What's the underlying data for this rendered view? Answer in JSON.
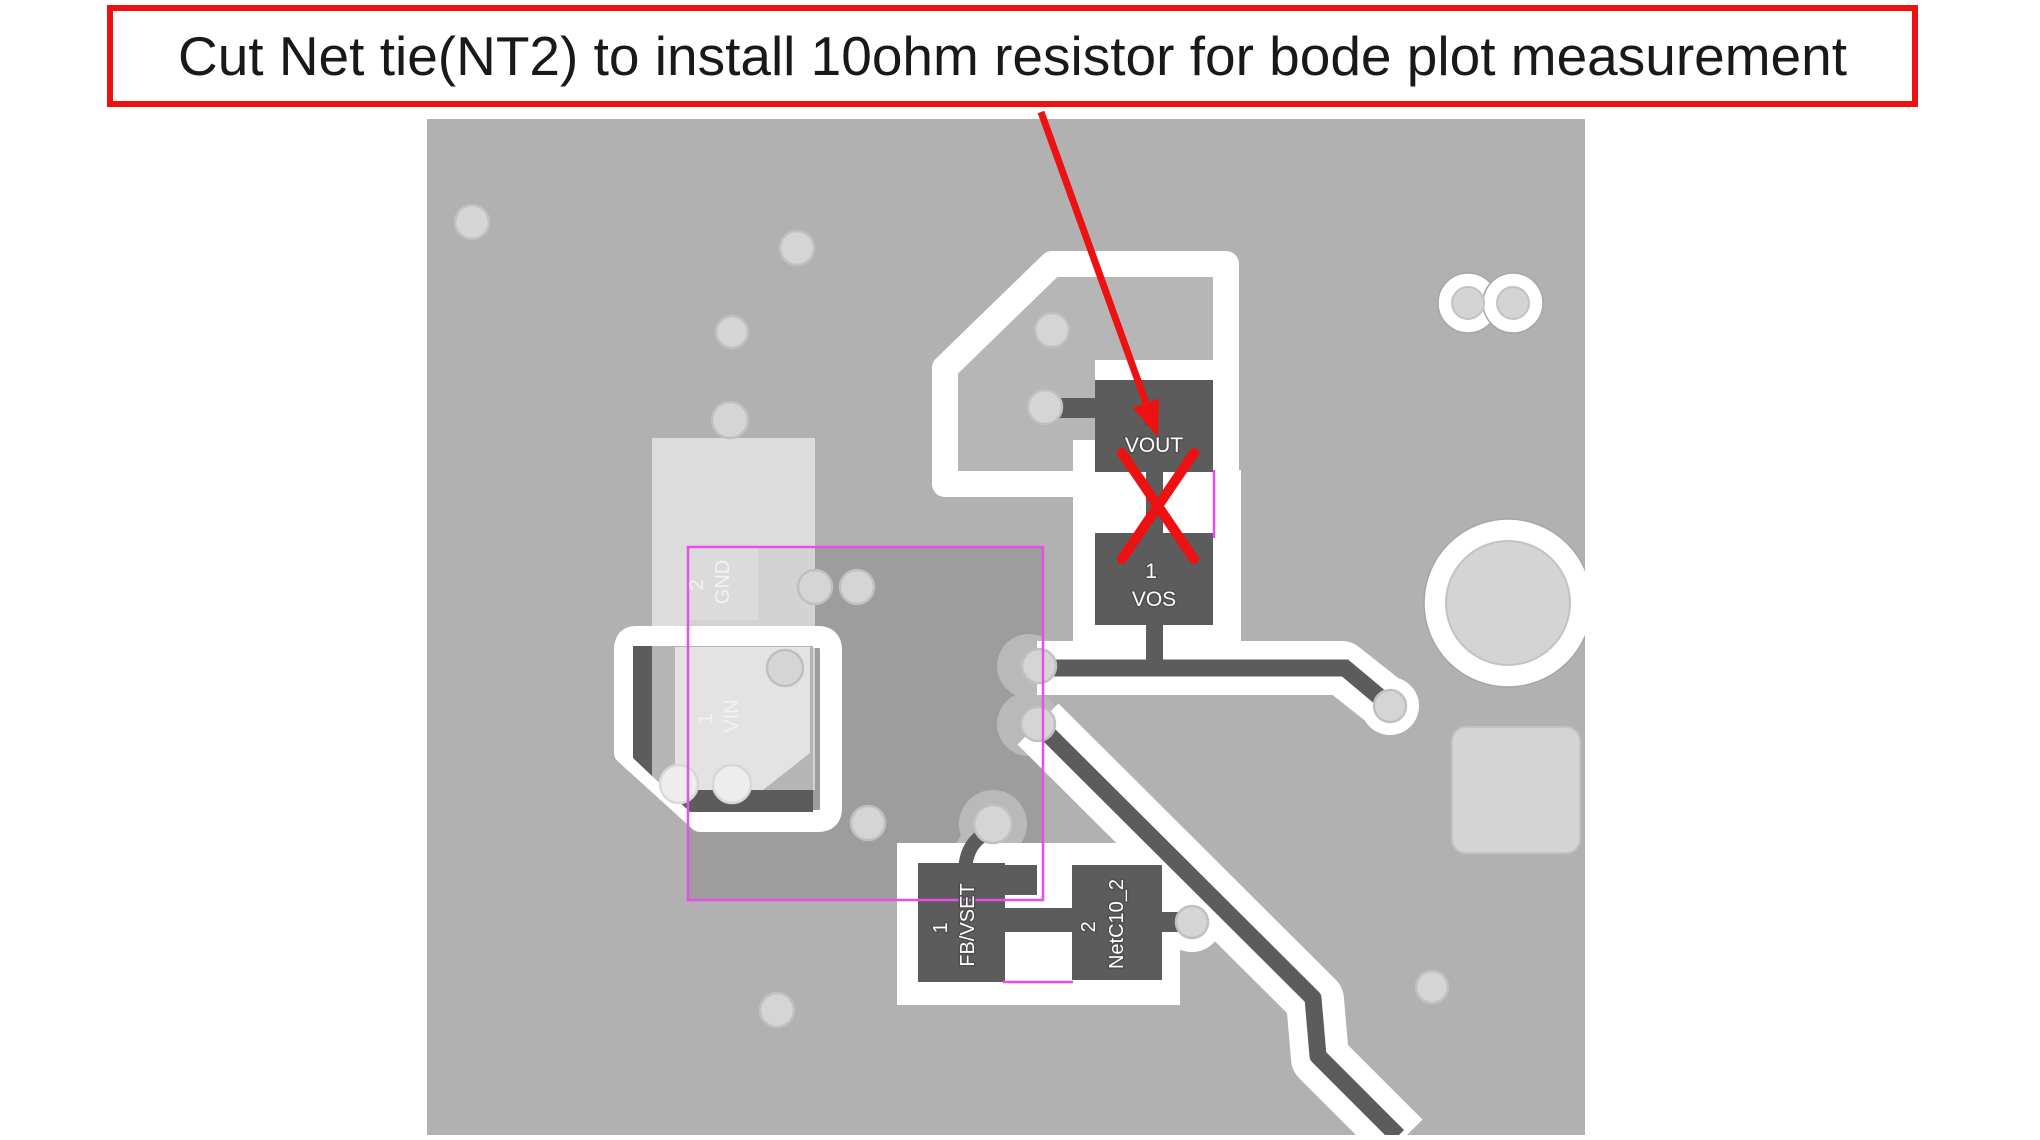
{
  "callout": {
    "text": "Cut Net tie(NT2) to install 10ohm resistor for bode plot measurement"
  },
  "board": {
    "pads": {
      "vout_pin": "2",
      "vout": "VOUT",
      "vos_pin": "1",
      "vos": "VOS",
      "fb_pin": "1",
      "fb": "FB/VSET",
      "netc_pin": "2",
      "netc": "NetC10_2",
      "gnd_pin": "2",
      "gnd": "GND",
      "vin_pin": "1",
      "vin": "VIN"
    }
  },
  "colors": {
    "red": "#ee1111",
    "magenta": "#e84fe8",
    "board": "#b1b1b1",
    "board_light": "#b6b6b6",
    "pour": "#9d9d9d",
    "copper": "#5c5c5c",
    "via": "#d5d5d5",
    "via_ring": "#c0c0c0",
    "bump": "#b9b9b9"
  }
}
